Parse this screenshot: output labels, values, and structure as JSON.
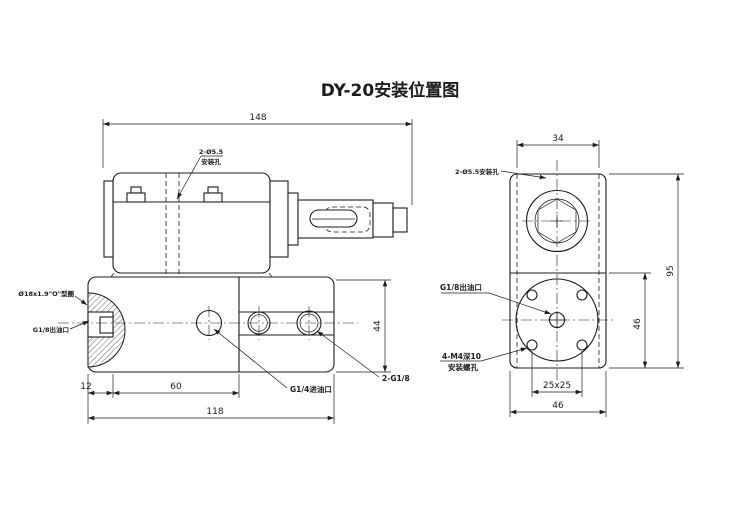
{
  "title": "DY-20安装位置图",
  "side_view": {
    "dims": {
      "top_width": "148",
      "right_height": "44",
      "bottom_left": "12",
      "bottom_mid": "60",
      "bottom_total": "118"
    },
    "labels": {
      "mount_hole_l1": "2-Ø5.5",
      "mount_hole_l2": "安装孔",
      "o_ring": "Ø18x1.9\"O\"型圈",
      "outlet_port": "G1/8出油口",
      "inlet_port": "G1/4进油口",
      "side_ports": "2-G1/8"
    }
  },
  "front_view": {
    "dims": {
      "top_width": "34",
      "right_height": "95",
      "inner_height": "46",
      "hole_square": "25x25",
      "bottom_width": "46"
    },
    "labels": {
      "mount_hole": "2-Ø5.5安装孔",
      "outlet_port": "G1/8出油口",
      "screw_l1": "4-M4深10",
      "screw_l2": "安装螺孔"
    }
  }
}
